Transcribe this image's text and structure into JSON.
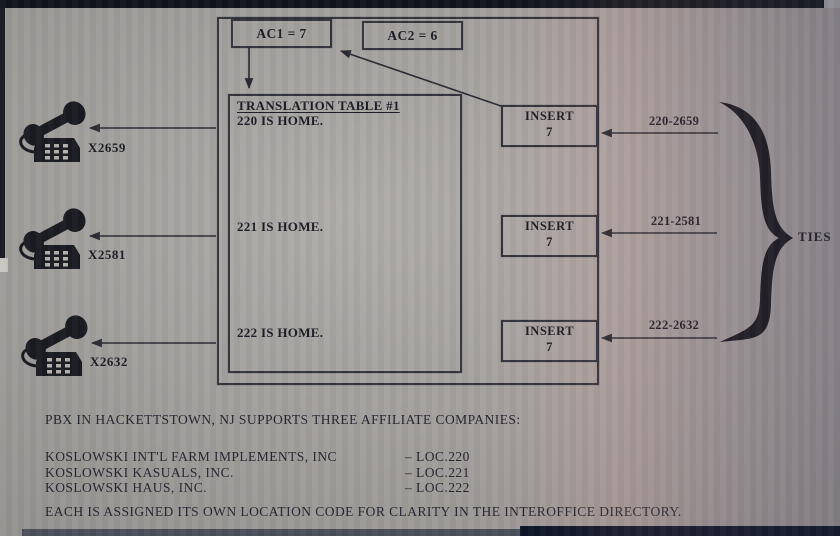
{
  "colors": {
    "ink": "#1c1c24",
    "line": "#2b2b33",
    "paper": "#a9a6a2"
  },
  "diagram": {
    "ac1_label": "AC1 = 7",
    "ac2_label": "AC2 = 6",
    "translation_table": {
      "title": "TRANSLATION TABLE #1",
      "rows": [
        "220 IS HOME.",
        "221 IS HOME.",
        "222 IS HOME."
      ]
    },
    "inserts": [
      {
        "word": "INSERT",
        "digit": "7"
      },
      {
        "word": "INSERT",
        "digit": "7"
      },
      {
        "word": "INSERT",
        "digit": "7"
      }
    ],
    "phones": [
      {
        "extension": "X2659"
      },
      {
        "extension": "X2581"
      },
      {
        "extension": "X2632"
      }
    ],
    "ties": [
      {
        "label": "220-2659"
      },
      {
        "label": "221-2581"
      },
      {
        "label": "222-2632"
      }
    ],
    "ties_label": "TIES"
  },
  "caption": {
    "intro": "PBX IN HACKETTSTOWN, NJ SUPPORTS THREE AFFILIATE COMPANIES:",
    "companies": [
      {
        "name": "KOSLOWSKI INT'L FARM IMPLEMENTS, INC",
        "loc": "– LOC.220"
      },
      {
        "name": "KOSLOWSKI KASUALS, INC.",
        "loc": "– LOC.221"
      },
      {
        "name": "KOSLOWSKI HAUS, INC.",
        "loc": "– LOC.222"
      }
    ],
    "outro": "EACH IS ASSIGNED ITS OWN LOCATION CODE FOR CLARITY IN THE INTEROFFICE DIRECTORY."
  }
}
